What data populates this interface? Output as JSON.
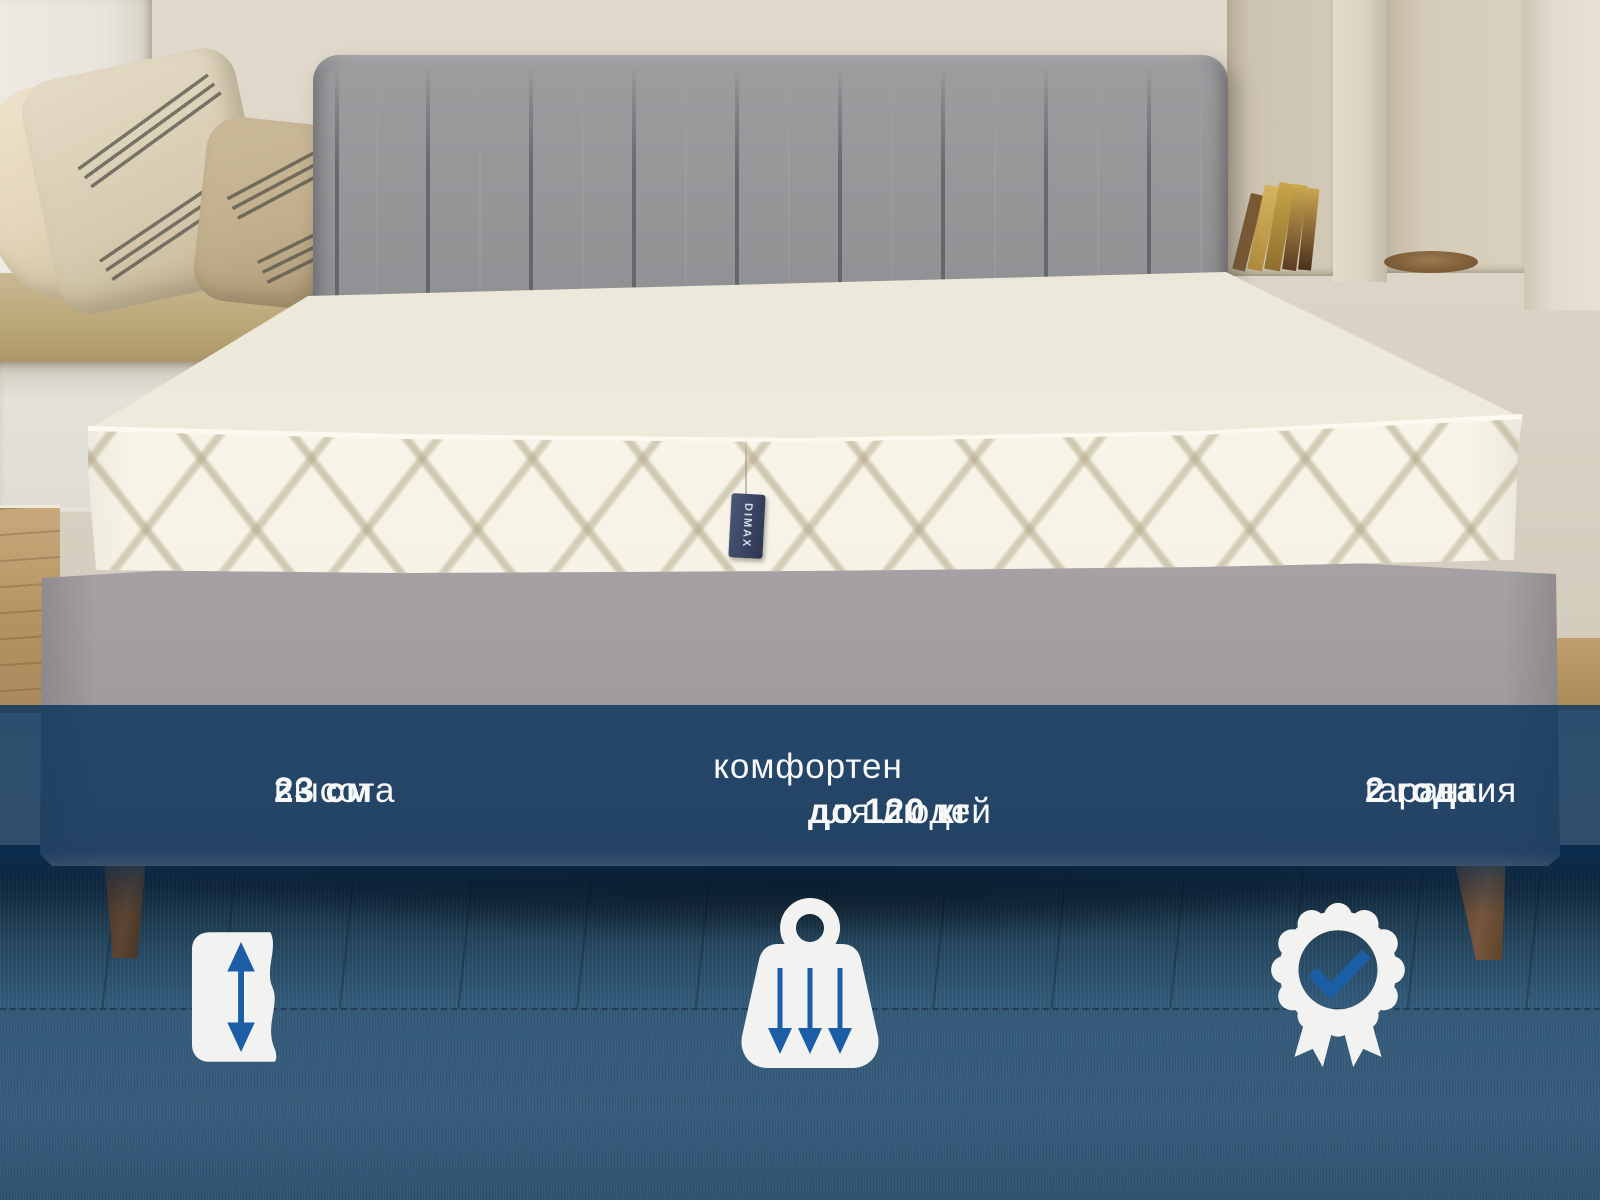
{
  "page": {
    "type": "product-photo-banner",
    "language": "ru",
    "scene": "white quilted mattress on a grey upholstered bed with channel-tufted headboard, beige wall with shelf niches and books, pillows on a bench at left, blue wooden floor"
  },
  "photo": {
    "brand_tag": "DIMAX"
  },
  "captions": {
    "height": {
      "label": "высота",
      "value": "23 см"
    },
    "comfort": {
      "line1": "комфортен",
      "line2_prefix": "для людей",
      "line2_value": "до 120 кг"
    },
    "warranty": {
      "label": "гарантия",
      "value": "2 года"
    }
  },
  "icons": {
    "height": "mattress-height-double-arrow",
    "weight": "weight-with-down-arrows",
    "warranty": "rosette-badge-checkmark"
  },
  "colors": {
    "accent_blue": "#1c5ea6",
    "overlay_navy": "#083056",
    "caption_text": "#f7f8f7",
    "icon_white": "#f2f3f1"
  }
}
